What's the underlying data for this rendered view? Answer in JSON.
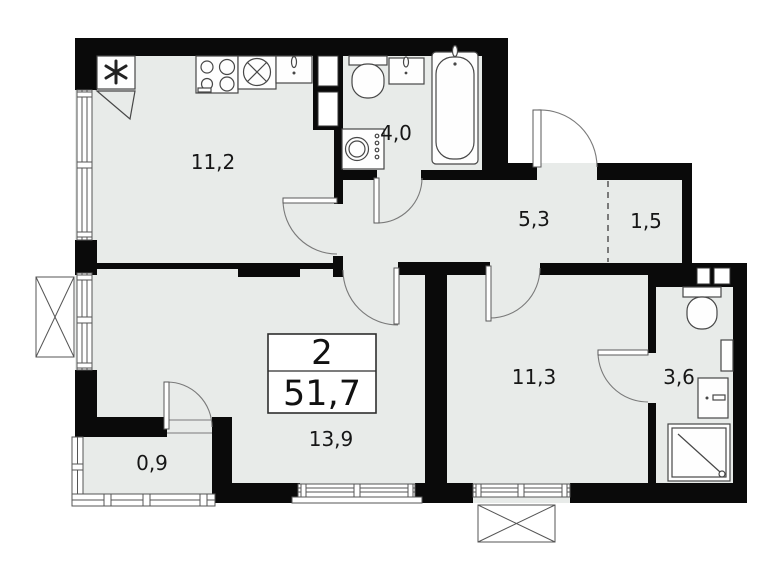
{
  "floorplan": {
    "summary": {
      "rooms_count": "2",
      "total_area": "51,7"
    },
    "rooms": [
      {
        "id": "kitchen",
        "area": "11,2"
      },
      {
        "id": "bathroom",
        "area": "4,0"
      },
      {
        "id": "hallway",
        "area": "5,3"
      },
      {
        "id": "storage",
        "area": "1,5"
      },
      {
        "id": "bedroom",
        "area": "11,3"
      },
      {
        "id": "shower-room",
        "area": "3,6"
      },
      {
        "id": "living-room",
        "area": "13,9"
      },
      {
        "id": "balcony",
        "area": "0,9"
      }
    ],
    "fixtures": [
      "refrigerator",
      "stove",
      "kitchen-sink",
      "countertop-basin",
      "toilet",
      "washbasin",
      "bathtub",
      "washing-machine",
      "toilet-2",
      "washbasin-2",
      "towel-radiator",
      "shower-tray",
      "ventilation-shaft",
      "exterior-ac-box"
    ],
    "colors": {
      "floor": "#e8ebe9",
      "walls": "#0a0a0a",
      "fixture_outline": "#474747"
    }
  }
}
